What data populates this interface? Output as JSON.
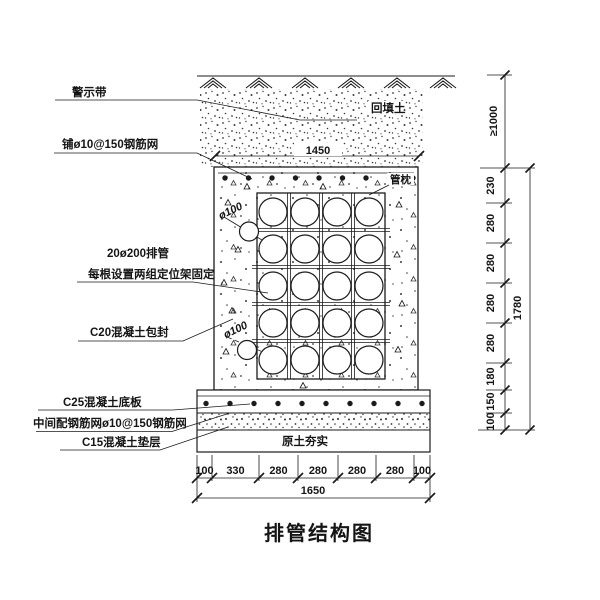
{
  "title": "排管结构图",
  "annotations": {
    "warning_tape": "警示带",
    "top_mesh": "铺ø10@150钢筋网",
    "backfill": "回填土",
    "pipe_cradle": "管枕",
    "pipes_line1": "20ø200排管",
    "pipes_line2": "每根设置两组定位架固定",
    "encasement": "C20混凝土包封",
    "small_pipe_top": "ø100",
    "small_pipe_bottom": "ø100",
    "base_slab": "C25混凝土底板",
    "middle_mesh": "中间配钢筋网ø10@150钢筋网",
    "cushion": "C15混凝土垫层",
    "compacted_soil": "原土夯实"
  },
  "dimensions": {
    "top_width": "1450",
    "cover_depth": "≥1000",
    "right_segments": [
      "230",
      "280",
      "280",
      "280",
      "280",
      "180",
      "150",
      "100"
    ],
    "right_total": "1780",
    "bottom_segments": [
      "100",
      "330",
      "280",
      "280",
      "280",
      "280",
      "100"
    ],
    "bottom_total": "1650"
  },
  "colors": {
    "line": "#1b1b1b",
    "background": "#ffffff",
    "stipple": "#3a3a3a"
  }
}
